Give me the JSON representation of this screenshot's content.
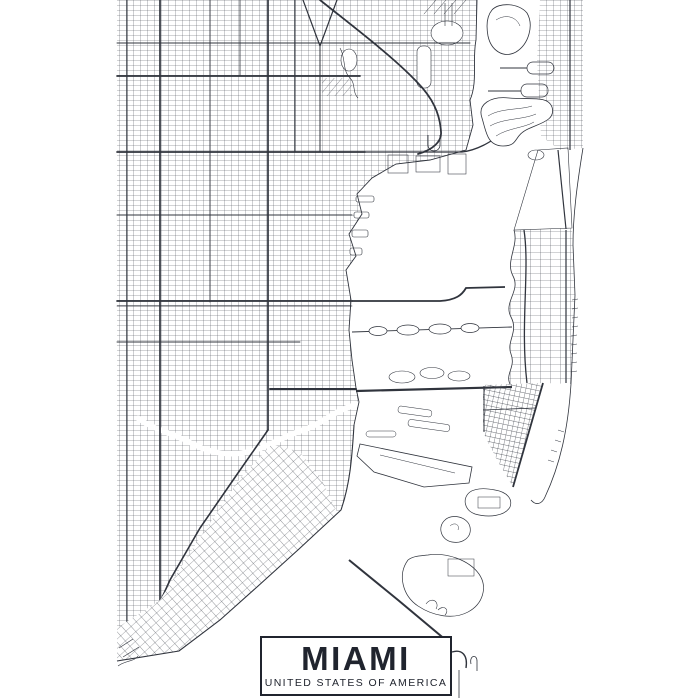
{
  "poster": {
    "title": "MIAMI",
    "subtitle": "UNITED STATES OF AMERICA",
    "colors": {
      "background": "#ffffff",
      "map_ink": "#30343d",
      "map_ink_fine": "#4b4f58",
      "title_ink": "#20242e",
      "title_box_background": "#ffffff",
      "title_box_border": "#20242e"
    }
  }
}
